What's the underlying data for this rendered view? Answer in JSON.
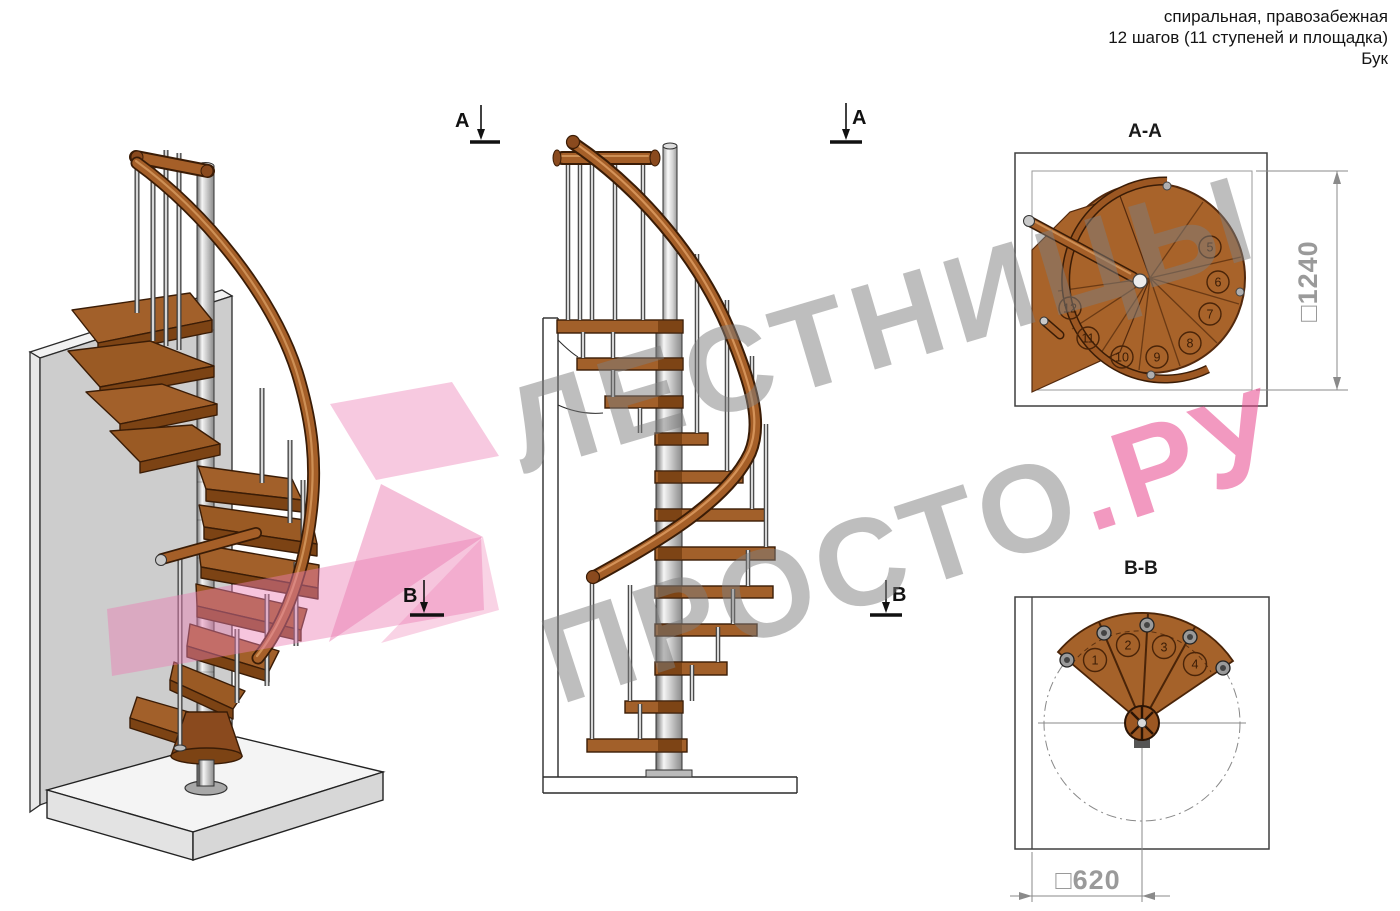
{
  "header": {
    "line1": "спиральная, правозабежная",
    "line2": "12 шагов (11 ступеней и площадка)",
    "line3": "Бук"
  },
  "watermark": {
    "line1": "ЛЕСТНИЦЫ",
    "line2_gray": "ПРОСТО",
    "line2_pink": ".РУ"
  },
  "sections": {
    "marker_a": "А",
    "marker_b": "В"
  },
  "plan_aa": {
    "title": "А-А",
    "dimension_label": "□1240",
    "step_numbers": [
      "5",
      "6",
      "7",
      "8",
      "9",
      "10",
      "11",
      "12"
    ]
  },
  "plan_bb": {
    "title": "В-В",
    "dimension_label": "□620",
    "step_numbers": [
      "1",
      "2",
      "3",
      "4"
    ]
  },
  "colors": {
    "wood": "#a2602a",
    "wood_dark": "#3a1c06",
    "handrail": "#a55f28",
    "metal_light": "#d6d6d6",
    "dimension_text": "#9a9a9a",
    "watermark_gray": "#7d7d7d",
    "watermark_pink": "#e8468c",
    "pink_arrow": "#ec7fb4"
  }
}
